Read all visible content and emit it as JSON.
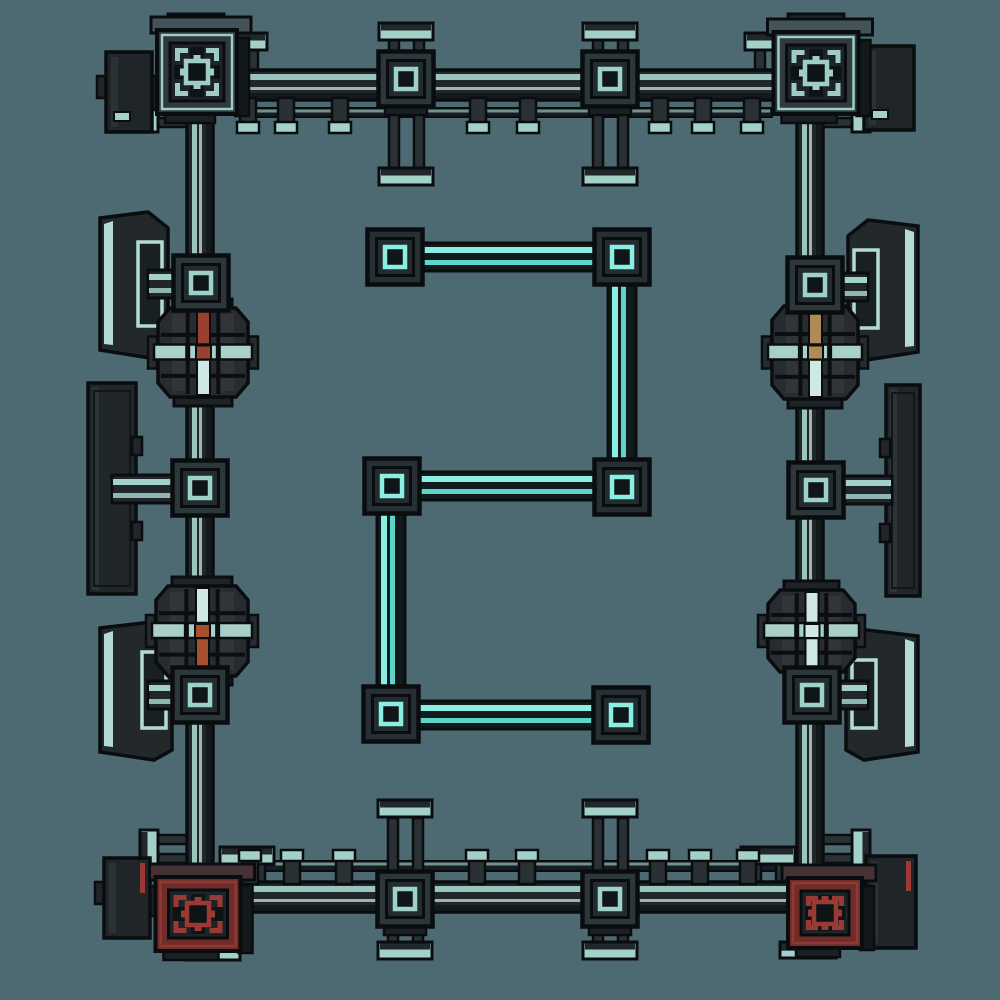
{
  "canvas": {
    "width": 1000,
    "height": 1000,
    "background": "#4d6971"
  },
  "palette": {
    "background": "#4d6971",
    "outline": "#0a0d0f",
    "cable_body": "#21282b",
    "cable_dark": "#14191c",
    "cable_stripe": "#9ac4bd",
    "cable_bright": "#cde2dd",
    "rail_body": "#161c1f",
    "rail_line": "#8fb9b2",
    "glow_body": "#111a1d",
    "glow_bright": "#8aeee2",
    "glow_mid": "#5ed5c9",
    "node_face": "#2c373a",
    "node_inner": "#222b2e",
    "node_ring": "#9ed1ca",
    "node_ring_dark": "#101517",
    "leg": "#2a3134",
    "cap_teal": "#a3d0c9",
    "cap_dark": "#21282b",
    "slab": "#23282b",
    "panel_edge": "#b4dad4",
    "screen": "#192023",
    "drum_body": "#282b2f",
    "drum_rib": "#383d41",
    "drum_cap": "#1d2326",
    "band": "#a9cfc9",
    "red": "#9c3f33",
    "orange": "#a8502e",
    "tan": "#b18a5a",
    "pale": "#cfe8e4",
    "corner_teal_band": "#2e3a3e",
    "corner_teal_line": "#9fccc6",
    "corner_red_band": "#702c28",
    "corner_red_line": "#8e3a33",
    "corner_red_accent": "#9b3a34",
    "corner_inner": "#1d2427",
    "corner_sq": "#0e1315",
    "corner_top_teal": "#44535a",
    "corner_top_red": "#443235",
    "side_face": "#13181a",
    "attach_body": "#1f2528",
    "attach_shade": "#3a4245",
    "lip": "#1a2023"
  },
  "scene": {
    "rails": [
      {
        "name": "rail-top",
        "interactable": false,
        "x1": 240,
        "x2": 772,
        "y": 108,
        "h": 9
      },
      {
        "name": "rail-bottom",
        "interactable": false,
        "x1": 236,
        "x2": 788,
        "y": 861,
        "h": 10
      }
    ],
    "pillars": [
      {
        "name": "cap-post-top1-up",
        "interactable": false,
        "dir": "up",
        "cx": 406,
        "legY1": 40,
        "legY2": 57,
        "capY": 23
      },
      {
        "name": "cap-post-top1-down",
        "interactable": false,
        "dir": "down",
        "cx": 406,
        "legY1": 104,
        "legY2": 170,
        "capY": 168
      },
      {
        "name": "cap-post-top2-up",
        "interactable": false,
        "dir": "up",
        "cx": 610,
        "legY1": 40,
        "legY2": 57,
        "capY": 23
      },
      {
        "name": "cap-post-top2-down",
        "interactable": false,
        "dir": "down",
        "cx": 610,
        "legY1": 104,
        "legY2": 170,
        "capY": 168
      },
      {
        "name": "cap-post-bottom1-up",
        "interactable": false,
        "dir": "up",
        "cx": 405,
        "legY1": 818,
        "legY2": 875,
        "capY": 800
      },
      {
        "name": "cap-post-bottom1-down",
        "interactable": false,
        "dir": "down",
        "cx": 405,
        "legY1": 924,
        "legY2": 944,
        "capY": 942
      },
      {
        "name": "cap-post-bottom2-up",
        "interactable": false,
        "dir": "up",
        "cx": 610,
        "legY1": 818,
        "legY2": 875,
        "capY": 800
      },
      {
        "name": "cap-post-bottom2-down",
        "interactable": false,
        "dir": "down",
        "cx": 610,
        "legY1": 924,
        "legY2": 944,
        "capY": 942
      },
      {
        "name": "cap-post-corner-tl",
        "interactable": false,
        "dir": "up",
        "cx": 240,
        "legY1": 50,
        "legY2": 72,
        "capY": 33
      },
      {
        "name": "cap-post-corner-tr",
        "interactable": false,
        "dir": "up",
        "cx": 772,
        "legY1": 50,
        "legY2": 72,
        "capY": 33
      },
      {
        "name": "cap-post-corner-bl",
        "interactable": false,
        "dir": "up",
        "cx": 247,
        "legY1": 864,
        "legY2": 886,
        "capY": 847
      },
      {
        "name": "cap-post-corner-br",
        "interactable": false,
        "dir": "up",
        "cx": 768,
        "legY1": 864,
        "legY2": 886,
        "capY": 847
      },
      {
        "name": "side-post-top-left",
        "interactable": false,
        "dir": "left",
        "cy": 113,
        "legX1": 158,
        "legX2": 192,
        "capX": 140
      },
      {
        "name": "side-post-top-right",
        "interactable": false,
        "dir": "right",
        "cy": 113,
        "legX1": 818,
        "legX2": 852,
        "capX": 852
      },
      {
        "name": "side-post-bottom-left",
        "interactable": false,
        "dir": "left",
        "cy": 849,
        "legX1": 158,
        "legX2": 192,
        "capX": 140
      },
      {
        "name": "side-post-bottom-right",
        "interactable": false,
        "dir": "right",
        "cy": 849,
        "legX1": 818,
        "legX2": 852,
        "capX": 852
      }
    ],
    "attachments": [
      {
        "name": "side-block-top-left",
        "interactable": true,
        "x": 106,
        "y": 52,
        "w": 46,
        "h": 80,
        "accent": "teal",
        "bridge": [
          148,
          76,
          14,
          34
        ]
      },
      {
        "name": "side-block-top-right",
        "interactable": true,
        "x": 864,
        "y": 46,
        "w": 50,
        "h": 84,
        "accent": "teal",
        "bridge": [
          850,
          80,
          16,
          30
        ]
      },
      {
        "name": "side-block-bottom-left",
        "interactable": true,
        "x": 104,
        "y": 858,
        "w": 46,
        "h": 80,
        "accent": "red",
        "bridge": [
          146,
          886,
          14,
          30
        ]
      },
      {
        "name": "side-block-bottom-right",
        "interactable": true,
        "x": 866,
        "y": 856,
        "w": 50,
        "h": 92,
        "accent": "red",
        "bridge": [
          854,
          884,
          14,
          30
        ]
      }
    ],
    "panels": [
      {
        "name": "display-panel-left-top",
        "interactable": true,
        "type": "wedge",
        "x": 100,
        "y": 212,
        "w": 68,
        "h": 146,
        "side": "left"
      },
      {
        "name": "display-panel-left-middle",
        "interactable": true,
        "type": "flat",
        "x": 88,
        "y": 383,
        "w": 48,
        "h": 211,
        "side": "left"
      },
      {
        "name": "display-panel-left-bottom",
        "interactable": true,
        "type": "wedge",
        "x": 100,
        "y": 622,
        "w": 72,
        "h": 138,
        "side": "left"
      },
      {
        "name": "display-panel-right-top",
        "interactable": true,
        "type": "wedge",
        "x": 848,
        "y": 220,
        "w": 70,
        "h": 140,
        "side": "right"
      },
      {
        "name": "display-panel-right-middle",
        "interactable": true,
        "type": "flat",
        "x": 886,
        "y": 385,
        "w": 34,
        "h": 211,
        "side": "right"
      },
      {
        "name": "display-panel-right-bottom",
        "interactable": true,
        "type": "wedge",
        "x": 846,
        "y": 630,
        "w": 72,
        "h": 130,
        "side": "right"
      }
    ],
    "connectors": [
      {
        "name": "panel-link-left-top",
        "interactable": false,
        "x1": 148,
        "x2": 186,
        "y": 284
      },
      {
        "name": "panel-link-left-middle",
        "interactable": false,
        "x1": 112,
        "x2": 186,
        "y": 489
      },
      {
        "name": "panel-link-left-bottom",
        "interactable": false,
        "x1": 148,
        "x2": 186,
        "y": 695
      },
      {
        "name": "panel-link-right-top",
        "interactable": false,
        "x1": 828,
        "x2": 868,
        "y": 287
      },
      {
        "name": "panel-link-right-middle",
        "interactable": false,
        "x1": 832,
        "x2": 892,
        "y": 490
      },
      {
        "name": "panel-link-right-bottom",
        "interactable": false,
        "x1": 828,
        "x2": 868,
        "y": 695
      }
    ],
    "cables_outer": [
      {
        "name": "frame-cable-top",
        "interactable": true,
        "kind": "h",
        "x1": 190,
        "x2": 812,
        "y": 85
      },
      {
        "name": "frame-cable-bottom",
        "interactable": true,
        "kind": "h",
        "x1": 194,
        "x2": 816,
        "y": 897
      },
      {
        "name": "frame-cable-left",
        "interactable": true,
        "kind": "v",
        "x": 200,
        "y1": 94,
        "y2": 890
      },
      {
        "name": "frame-cable-right",
        "interactable": true,
        "kind": "v",
        "x": 810,
        "y1": 94,
        "y2": 890
      }
    ],
    "stubs": [
      {
        "name": "stub-top-a",
        "interactable": false,
        "cx": 248,
        "y": 98,
        "dir": "down"
      },
      {
        "name": "stub-top-b",
        "interactable": false,
        "cx": 286,
        "y": 98,
        "dir": "down"
      },
      {
        "name": "stub-top-c",
        "interactable": false,
        "cx": 340,
        "y": 98,
        "dir": "down"
      },
      {
        "name": "stub-top-d",
        "interactable": false,
        "cx": 478,
        "y": 98,
        "dir": "down"
      },
      {
        "name": "stub-top-e",
        "interactable": false,
        "cx": 528,
        "y": 98,
        "dir": "down"
      },
      {
        "name": "stub-top-f",
        "interactable": false,
        "cx": 660,
        "y": 98,
        "dir": "down"
      },
      {
        "name": "stub-top-g",
        "interactable": false,
        "cx": 703,
        "y": 98,
        "dir": "down"
      },
      {
        "name": "stub-top-h",
        "interactable": false,
        "cx": 752,
        "y": 98,
        "dir": "down"
      },
      {
        "name": "stub-bottom-a",
        "interactable": false,
        "cx": 250,
        "y": 884,
        "dir": "up"
      },
      {
        "name": "stub-bottom-b",
        "interactable": false,
        "cx": 292,
        "y": 884,
        "dir": "up"
      },
      {
        "name": "stub-bottom-c",
        "interactable": false,
        "cx": 344,
        "y": 884,
        "dir": "up"
      },
      {
        "name": "stub-bottom-d",
        "interactable": false,
        "cx": 477,
        "y": 884,
        "dir": "up"
      },
      {
        "name": "stub-bottom-e",
        "interactable": false,
        "cx": 527,
        "y": 884,
        "dir": "up"
      },
      {
        "name": "stub-bottom-f",
        "interactable": false,
        "cx": 658,
        "y": 884,
        "dir": "up"
      },
      {
        "name": "stub-bottom-g",
        "interactable": false,
        "cx": 700,
        "y": 884,
        "dir": "up"
      },
      {
        "name": "stub-bottom-h",
        "interactable": false,
        "cx": 748,
        "y": 884,
        "dir": "up"
      }
    ],
    "drums": [
      {
        "name": "machine-drum-left-top",
        "interactable": true,
        "x": 158,
        "y": 308,
        "w": 90,
        "h": 89,
        "top": "red",
        "bottom": "pale",
        "center": "red"
      },
      {
        "name": "machine-drum-left-bottom",
        "interactable": true,
        "x": 156,
        "y": 586,
        "w": 92,
        "h": 90,
        "top": "pale",
        "bottom": "orange",
        "center": "orange"
      },
      {
        "name": "machine-drum-right-top",
        "interactable": true,
        "x": 772,
        "y": 306,
        "w": 86,
        "h": 93,
        "top": "tan",
        "bottom": "pale",
        "center": "tan"
      },
      {
        "name": "machine-drum-right-bottom",
        "interactable": true,
        "x": 768,
        "y": 590,
        "w": 87,
        "h": 82,
        "top": "pale",
        "bottom": "pale",
        "center": "pale"
      }
    ],
    "corner_caps": [
      {
        "name": "corner-cap-top-left",
        "interactable": false,
        "x": 168,
        "y": 14,
        "w": 56,
        "h": 18
      },
      {
        "name": "corner-cap-top-right",
        "interactable": false,
        "x": 788,
        "y": 14,
        "w": 56,
        "h": 18
      },
      {
        "name": "corner-cap-bottom-left",
        "interactable": false,
        "x": 186,
        "y": 944,
        "w": 54,
        "h": 16
      },
      {
        "name": "corner-cap-bottom-right",
        "interactable": false,
        "x": 780,
        "y": 942,
        "w": 56,
        "h": 16
      }
    ],
    "corners": [
      {
        "name": "corner-block-top-left",
        "interactable": true,
        "cx": 197,
        "cy": 72,
        "w": 80,
        "h": 84,
        "accent": "teal"
      },
      {
        "name": "corner-block-top-right",
        "interactable": true,
        "cx": 816,
        "cy": 73,
        "w": 85,
        "h": 82,
        "accent": "teal"
      },
      {
        "name": "corner-block-bottom-left",
        "interactable": true,
        "cx": 198,
        "cy": 914,
        "w": 85,
        "h": 74,
        "accent": "red"
      },
      {
        "name": "corner-block-bottom-right",
        "interactable": true,
        "cx": 825,
        "cy": 913,
        "w": 74,
        "h": 70,
        "accent": "red"
      }
    ],
    "nodes_outer": [
      {
        "name": "junction-top-1",
        "interactable": true,
        "cx": 406,
        "cy": 79,
        "lip": true
      },
      {
        "name": "junction-top-2",
        "interactable": true,
        "cx": 610,
        "cy": 79,
        "lip": true
      },
      {
        "name": "junction-bottom-1",
        "interactable": true,
        "cx": 405,
        "cy": 899,
        "lip": true
      },
      {
        "name": "junction-bottom-2",
        "interactable": true,
        "cx": 610,
        "cy": 899,
        "lip": true
      },
      {
        "name": "junction-left-1",
        "interactable": true,
        "cx": 201,
        "cy": 283
      },
      {
        "name": "junction-left-2",
        "interactable": true,
        "cx": 200,
        "cy": 488
      },
      {
        "name": "junction-left-3",
        "interactable": true,
        "cx": 200,
        "cy": 695
      },
      {
        "name": "junction-right-1",
        "interactable": true,
        "cx": 815,
        "cy": 285
      },
      {
        "name": "junction-right-2",
        "interactable": true,
        "cx": 816,
        "cy": 490
      },
      {
        "name": "junction-right-3",
        "interactable": true,
        "cx": 812,
        "cy": 695
      }
    ],
    "cables_inner": [
      {
        "name": "glow-cable-top",
        "interactable": true,
        "kind": "h",
        "x1": 412,
        "x2": 604,
        "y": 257
      },
      {
        "name": "glow-cable-right-upper",
        "interactable": true,
        "kind": "v",
        "x": 622,
        "y1": 276,
        "y2": 470
      },
      {
        "name": "glow-cable-middle",
        "interactable": true,
        "kind": "h",
        "x1": 414,
        "x2": 600,
        "y": 486
      },
      {
        "name": "glow-cable-left-lower",
        "interactable": true,
        "kind": "v",
        "x": 391,
        "y1": 506,
        "y2": 696
      },
      {
        "name": "glow-cable-bottom",
        "interactable": true,
        "kind": "h",
        "x1": 413,
        "x2": 598,
        "y": 715
      }
    ],
    "nodes_inner": [
      {
        "name": "glow-junction-a",
        "interactable": true,
        "cx": 395,
        "cy": 257
      },
      {
        "name": "glow-junction-b",
        "interactable": true,
        "cx": 622,
        "cy": 257
      },
      {
        "name": "glow-junction-c",
        "interactable": true,
        "cx": 622,
        "cy": 487
      },
      {
        "name": "glow-junction-d",
        "interactable": true,
        "cx": 392,
        "cy": 486
      },
      {
        "name": "glow-junction-e",
        "interactable": true,
        "cx": 391,
        "cy": 714
      },
      {
        "name": "glow-junction-f",
        "interactable": true,
        "cx": 621,
        "cy": 715
      }
    ]
  }
}
